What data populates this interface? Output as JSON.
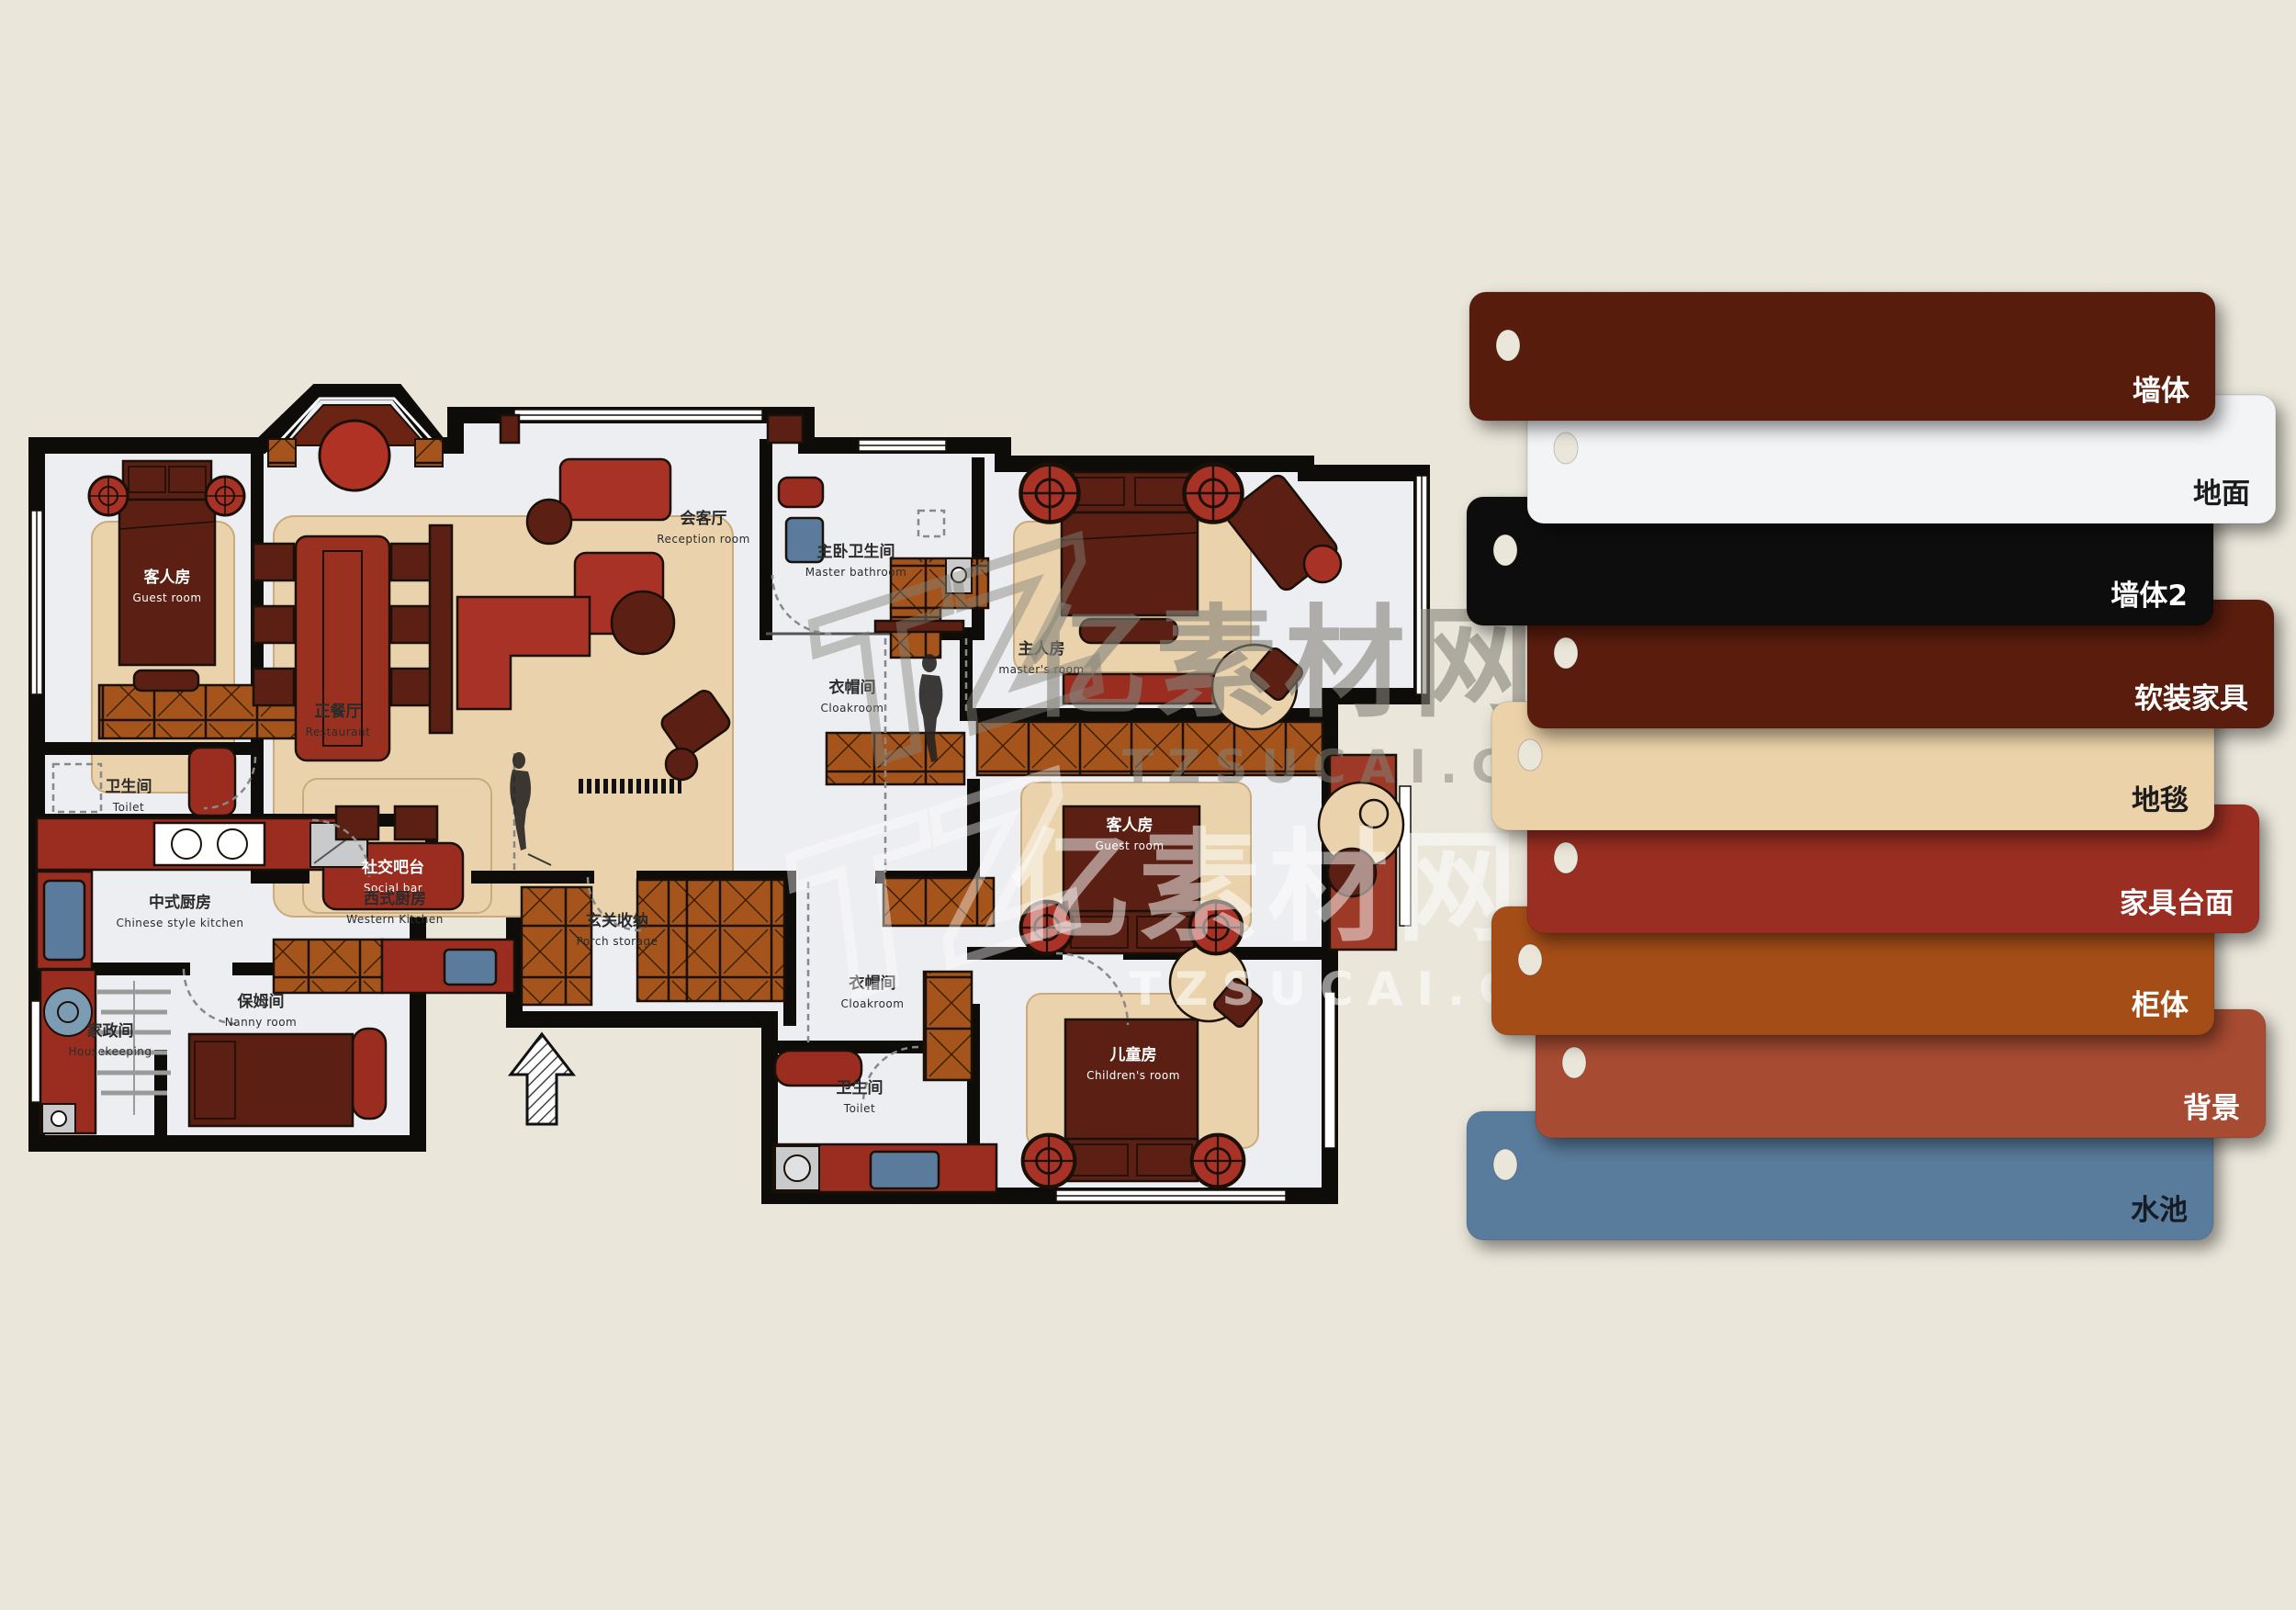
{
  "page": {
    "background": "#EDE9DD"
  },
  "watermark": {
    "brand": "亿素材网",
    "site": "TZSUCAI.COM",
    "logo": "TZ"
  },
  "floorplan": {
    "rooms": [
      {
        "id": "guest-room-tl",
        "zh": "客人房",
        "en": "Guest room"
      },
      {
        "id": "reception",
        "zh": "会客厅",
        "en": "Reception room"
      },
      {
        "id": "restaurant",
        "zh": "正餐厅",
        "en": "Restaurant"
      },
      {
        "id": "master-bathroom",
        "zh": "主卧卫生间",
        "en": "Master bathroom"
      },
      {
        "id": "cloakroom-upper",
        "zh": "衣帽间",
        "en": "Cloakroom"
      },
      {
        "id": "masters-room",
        "zh": "主人房",
        "en": "master's room"
      },
      {
        "id": "toilet-left",
        "zh": "卫生间",
        "en": "Toilet"
      },
      {
        "id": "social-bar",
        "zh": "社交吧台",
        "en": "Social bar"
      },
      {
        "id": "chinese-kitchen",
        "zh": "中式厨房",
        "en": "Chinese style kitchen"
      },
      {
        "id": "western-kitchen",
        "zh": "西式厨房",
        "en": "Western Kitchen"
      },
      {
        "id": "porch-storage",
        "zh": "玄关收纳",
        "en": "Porch storage"
      },
      {
        "id": "housekeeping",
        "zh": "家政间",
        "en": "Housekeeping"
      },
      {
        "id": "nanny-room",
        "zh": "保姆间",
        "en": "Nanny room"
      },
      {
        "id": "guest-room-r",
        "zh": "客人房",
        "en": "Guest room"
      },
      {
        "id": "cloakroom-lower",
        "zh": "衣帽间",
        "en": "Cloakroom"
      },
      {
        "id": "toilet-bottom",
        "zh": "卫生间",
        "en": "Toilet"
      },
      {
        "id": "childrens-room",
        "zh": "儿童房",
        "en": "Children's room"
      }
    ]
  },
  "palette": {
    "cards": [
      {
        "label": "墙体",
        "color": "#591F0D",
        "text_color": "#FFFFFF"
      },
      {
        "label": "地面",
        "color": "#F3F4F6",
        "text_color": "#1A1A1A"
      },
      {
        "label": "墙体2",
        "color": "#0C0907",
        "text_color": "#FFFFFF"
      },
      {
        "label": "软装家具",
        "color": "#5A1F0E",
        "text_color": "#FFFFFF"
      },
      {
        "label": "地毯",
        "color": "#EBD2A9",
        "text_color": "#1A1A1A"
      },
      {
        "label": "家具台面",
        "color": "#9A2D20",
        "text_color": "#FFFFFF"
      },
      {
        "label": "柜体",
        "color": "#A54E19",
        "text_color": "#FFFFFF"
      },
      {
        "label": "背景",
        "color": "#A74B33",
        "text_color": "#FFFFFF"
      },
      {
        "label": "水池",
        "color": "#5A7B9C",
        "text_color": "#141C26"
      }
    ]
  }
}
